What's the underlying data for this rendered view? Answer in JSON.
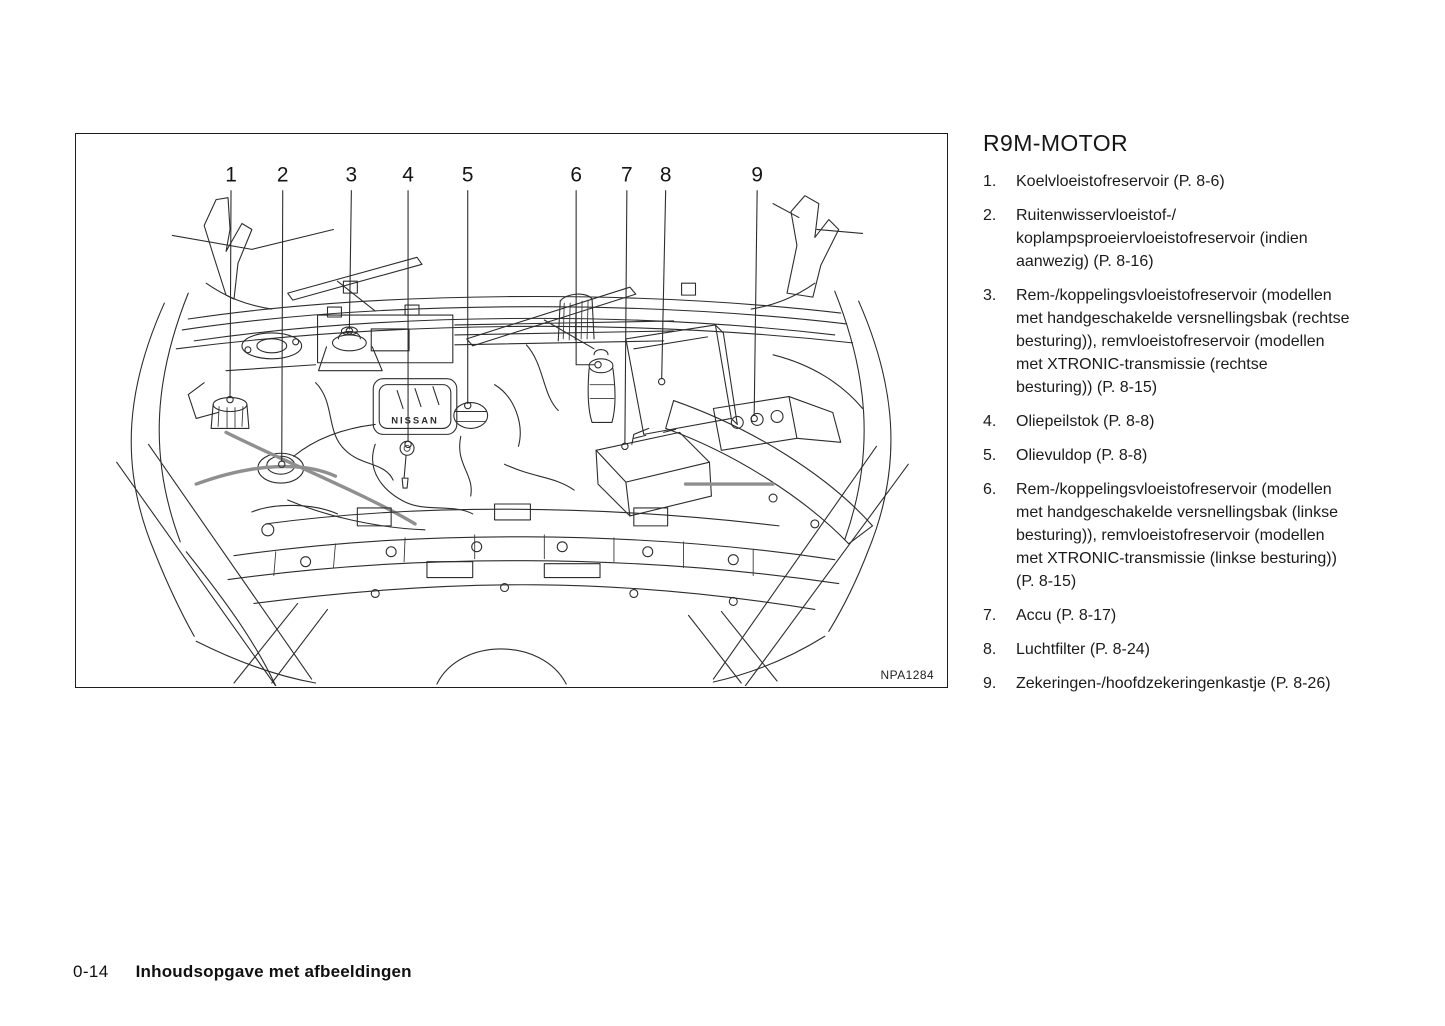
{
  "legend": {
    "title": "R9M-MOTOR",
    "items": [
      {
        "number": "1.",
        "lines": [
          "Koelvloeistofreservoir (P. 8-6)"
        ]
      },
      {
        "number": "2.",
        "lines": [
          "Ruitenwisservloeistof-/",
          "koplampsproeiervloeistofreservoir (indien",
          "aanwezig) (P. 8-16)"
        ]
      },
      {
        "number": "3.",
        "lines": [
          "Rem-/koppelingsvloeistofreservoir (modellen",
          "met handgeschakelde versnellingsbak (rechtse",
          "besturing)), remvloeistofreservoir (modellen",
          "met XTRONIC-transmissie (rechtse",
          "besturing)) (P. 8-15)"
        ]
      },
      {
        "number": "4.",
        "lines": [
          "Oliepeilstok (P. 8-8)"
        ]
      },
      {
        "number": "5.",
        "lines": [
          "Olievuldop (P. 8-8)"
        ]
      },
      {
        "number": "6.",
        "lines": [
          "Rem-/koppelingsvloeistofreservoir (modellen",
          "met handgeschakelde versnellingsbak (linkse",
          "besturing)), remvloeistofreservoir (modellen",
          "met XTRONIC-transmissie (linkse besturing))",
          "(P. 8-15)"
        ]
      },
      {
        "number": "7.",
        "lines": [
          "Accu (P. 8-17)"
        ]
      },
      {
        "number": "8.",
        "lines": [
          "Luchtfilter (P. 8-24)"
        ]
      },
      {
        "number": "9.",
        "lines": [
          "Zekeringen-/hoofdzekeringenkastje (P. 8-26)"
        ]
      }
    ]
  },
  "figure": {
    "image_code": "NPA1284",
    "engine_label": "NISSAN",
    "callouts": [
      {
        "label": "1",
        "x": 155,
        "points": [
          [
            155,
            57
          ],
          [
            154,
            264
          ]
        ],
        "dot": [
          154,
          267
        ]
      },
      {
        "label": "2",
        "x": 207,
        "points": [
          [
            207,
            57
          ],
          [
            206,
            329
          ]
        ],
        "dot": [
          206,
          332
        ]
      },
      {
        "label": "3",
        "x": 276,
        "points": [
          [
            276,
            57
          ],
          [
            274,
            196
          ]
        ],
        "dot": [
          274,
          198
        ]
      },
      {
        "label": "4",
        "x": 333,
        "points": [
          [
            333,
            57
          ],
          [
            333,
            309
          ]
        ],
        "dot": [
          333,
          312
        ]
      },
      {
        "label": "5",
        "x": 393,
        "points": [
          [
            393,
            57
          ],
          [
            393,
            271
          ]
        ],
        "dot": [
          393,
          273
        ]
      },
      {
        "label": "6",
        "x": 502,
        "points": [
          [
            502,
            57
          ],
          [
            502,
            232
          ],
          [
            520,
            232
          ]
        ],
        "dot": [
          524,
          232
        ]
      },
      {
        "label": "7",
        "x": 553,
        "points": [
          [
            553,
            57
          ],
          [
            551,
            311
          ]
        ],
        "dot": [
          551,
          314
        ]
      },
      {
        "label": "8",
        "x": 592,
        "points": [
          [
            592,
            57
          ],
          [
            588,
            246
          ]
        ],
        "dot": [
          588,
          249
        ]
      },
      {
        "label": "9",
        "x": 684,
        "points": [
          [
            684,
            57
          ],
          [
            681,
            283
          ]
        ],
        "dot": [
          681,
          286
        ]
      }
    ]
  },
  "footer": {
    "page_number": "0-14",
    "section": "Inhoudsopgave met afbeeldingen"
  },
  "colors": {
    "ink": "#1a1a1a",
    "paper": "#ffffff",
    "line_art": "#2d2d2d"
  }
}
